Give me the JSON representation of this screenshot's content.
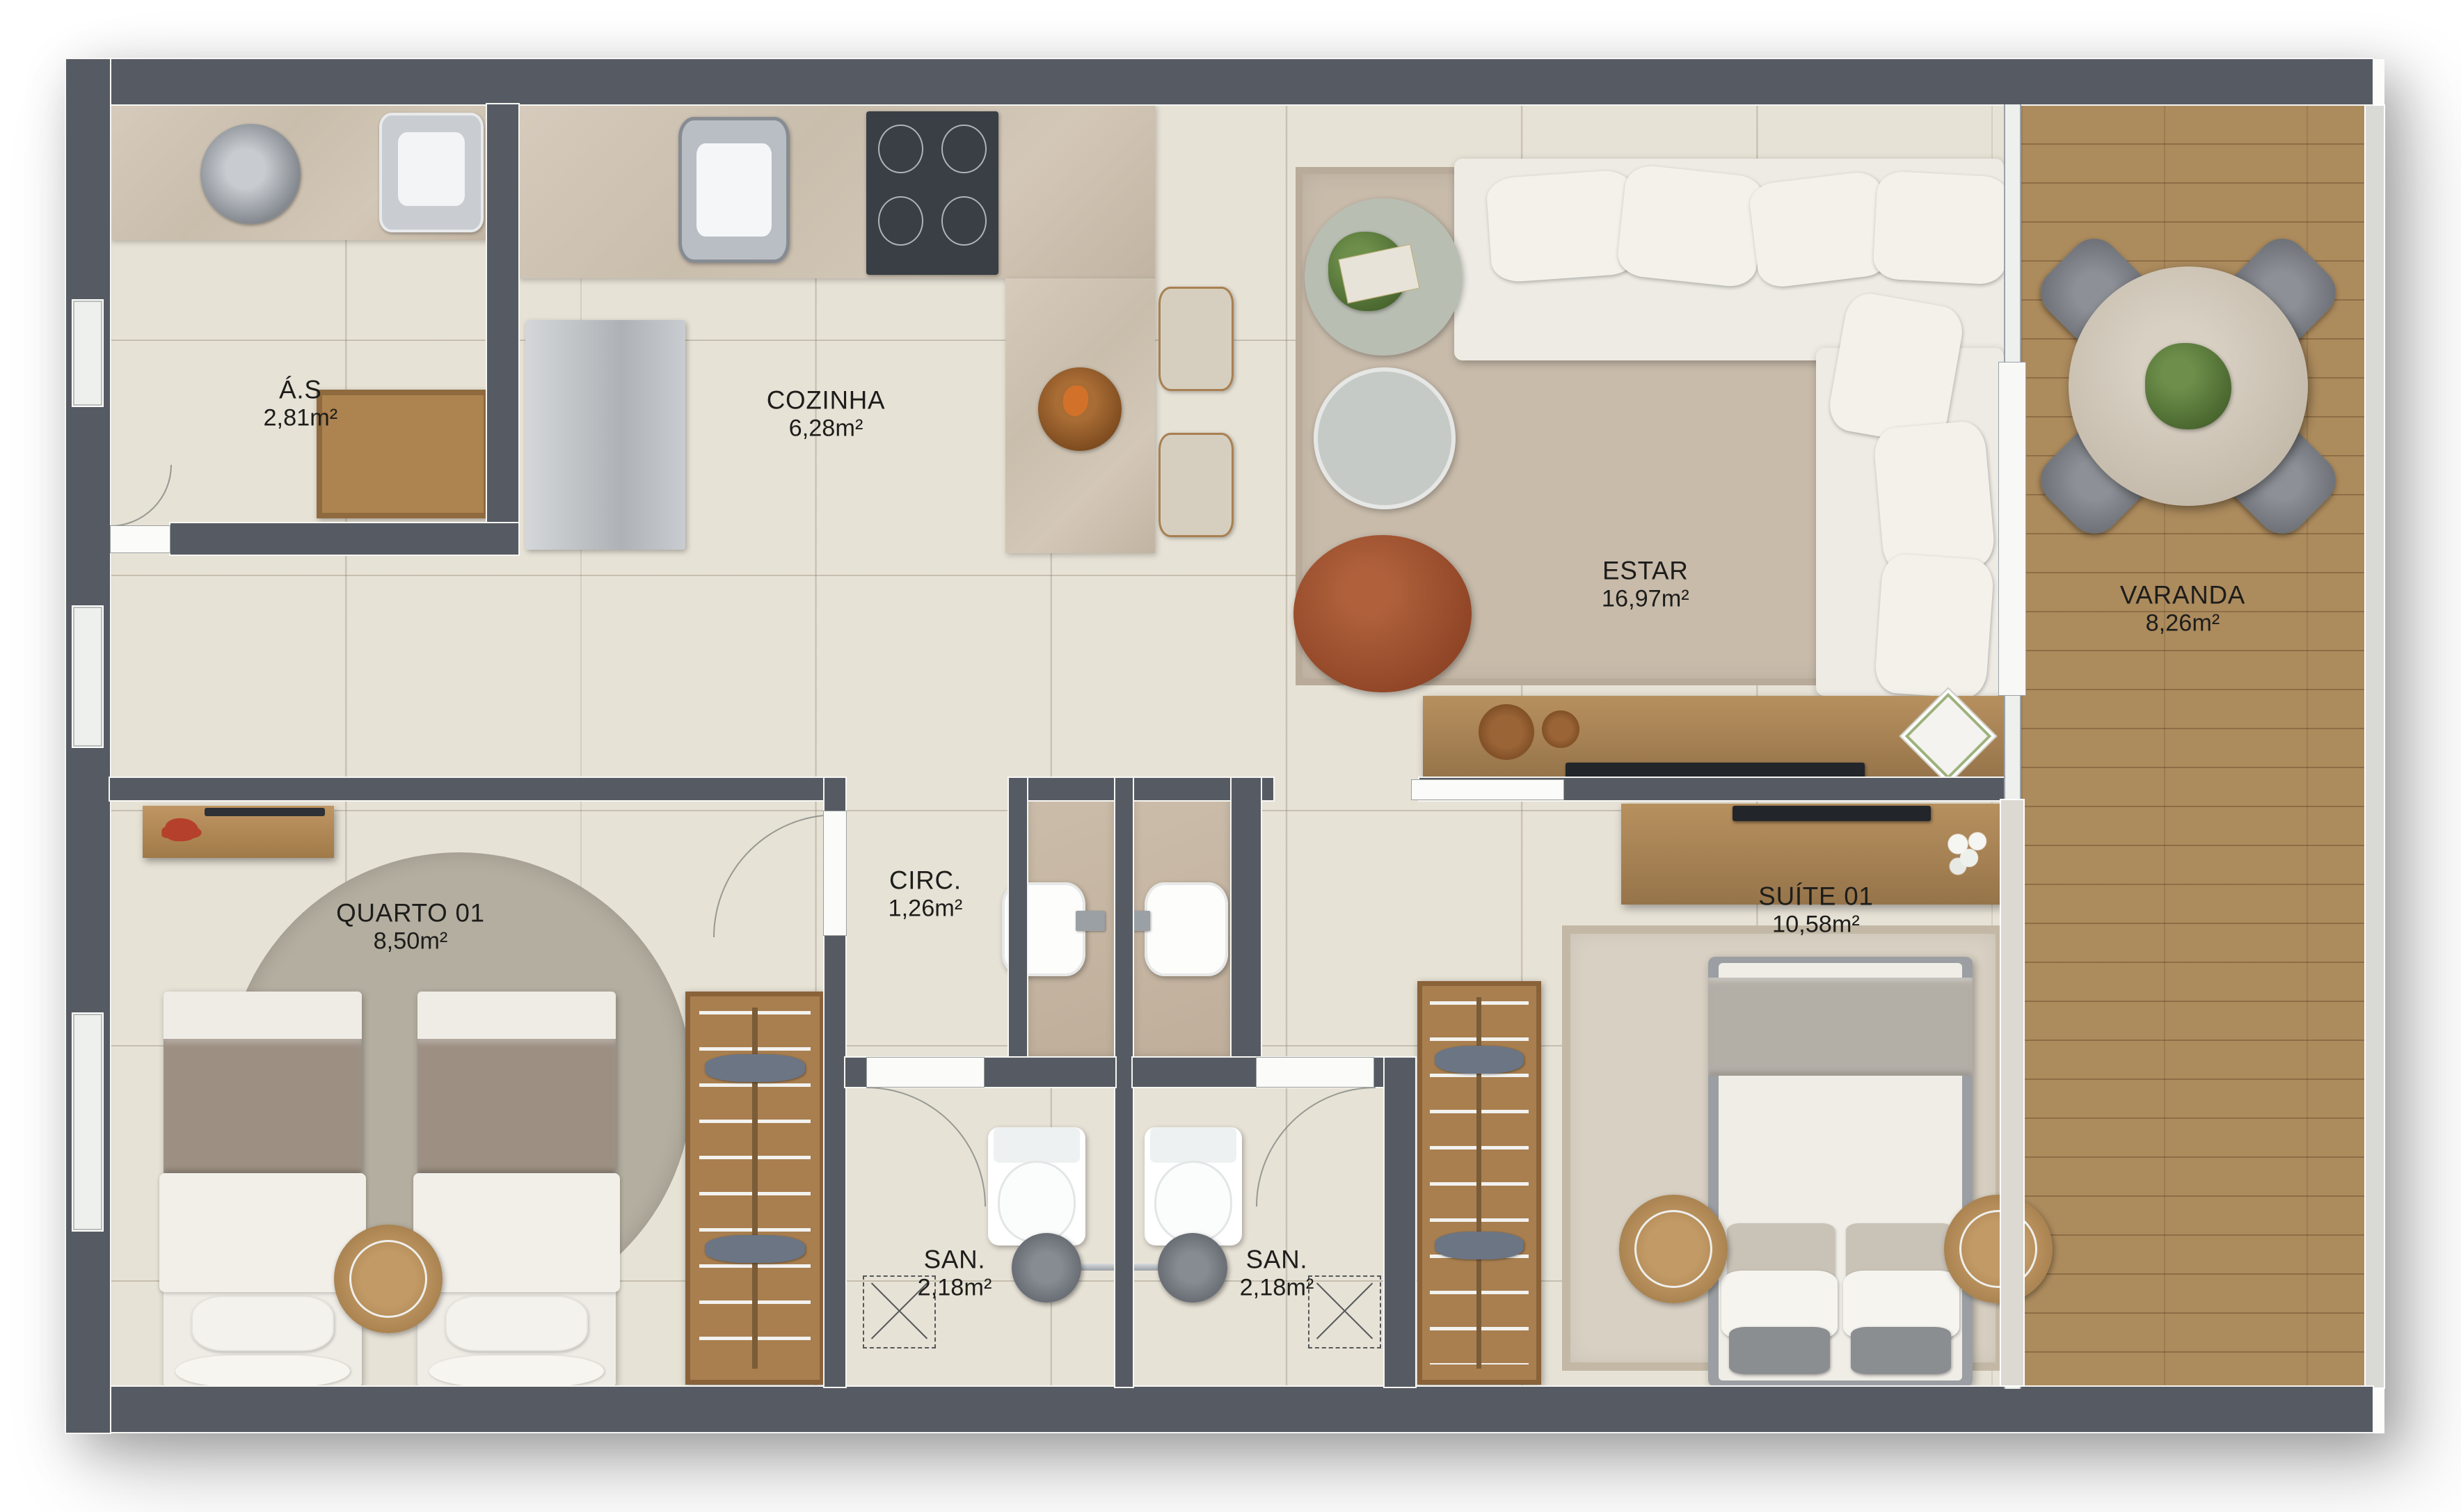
{
  "plan": {
    "type": "apartment-floor-plan",
    "rooms": {
      "servico": {
        "name": "Á.S",
        "area": "2,81m²"
      },
      "cozinha": {
        "name": "COZINHA",
        "area": "6,28m²"
      },
      "estar": {
        "name": "ESTAR",
        "area": "16,97m²"
      },
      "varanda": {
        "name": "VARANDA",
        "area": "8,26m²"
      },
      "quarto01": {
        "name": "QUARTO 01",
        "area": "8,50m²"
      },
      "circ": {
        "name": "CIRC.",
        "area": "1,26m²"
      },
      "suite01": {
        "name": "SUÍTE 01",
        "area": "10,58m²"
      },
      "san1": {
        "name": "SAN.",
        "area": "2,18m²"
      },
      "san2": {
        "name": "SAN.",
        "area": "2,18m²"
      }
    },
    "palette": {
      "wall": "#565b63",
      "floor_tile": "#e7e2d6",
      "marble_counter": "#cec2b2",
      "wood": "#b08a58",
      "deck": "#ac8b5d",
      "rug": "#c8bbaa",
      "accent_terracotta": "#9f4f2d",
      "background": "#ffffff"
    }
  }
}
